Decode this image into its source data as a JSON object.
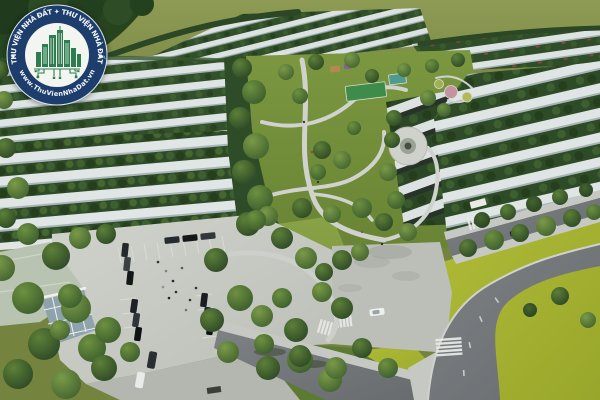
{
  "scene": {
    "description": "Aerial 3D architectural rendering of a residential land-subdivision master plan",
    "features": [
      "rows of white-roofed townhouses separated by tree lines",
      "central landscaped park with winding paths, plaza and sports court",
      "flower-bed garden circles",
      "parking plaza with parked cars and pedestrians",
      "curved asphalt access roads with zebra crosswalks",
      "open bright-green fields at the horizon and lower right"
    ]
  },
  "watermark": {
    "ring_text": "THƯ VIỆN NHÀ ĐẤT ✦ THƯ VIỆN NHÀ ĐẤT",
    "url_text": "www.ThuVienNhaDat.vn",
    "separator": "◆"
  },
  "palette": {
    "logo_navy": "#1d3e6d",
    "logo_green": "#2e7d50",
    "logo_paper": "#f3f5f0",
    "field_olive": "#7e8d46",
    "grass_bright": "#a9b433",
    "lawn_green": "#7c9740",
    "tree_dark": "#2c4827",
    "roof_white": "#dfe4e4",
    "pavement_gray": "#c9ccc6",
    "asphalt_gray": "#75797c"
  }
}
